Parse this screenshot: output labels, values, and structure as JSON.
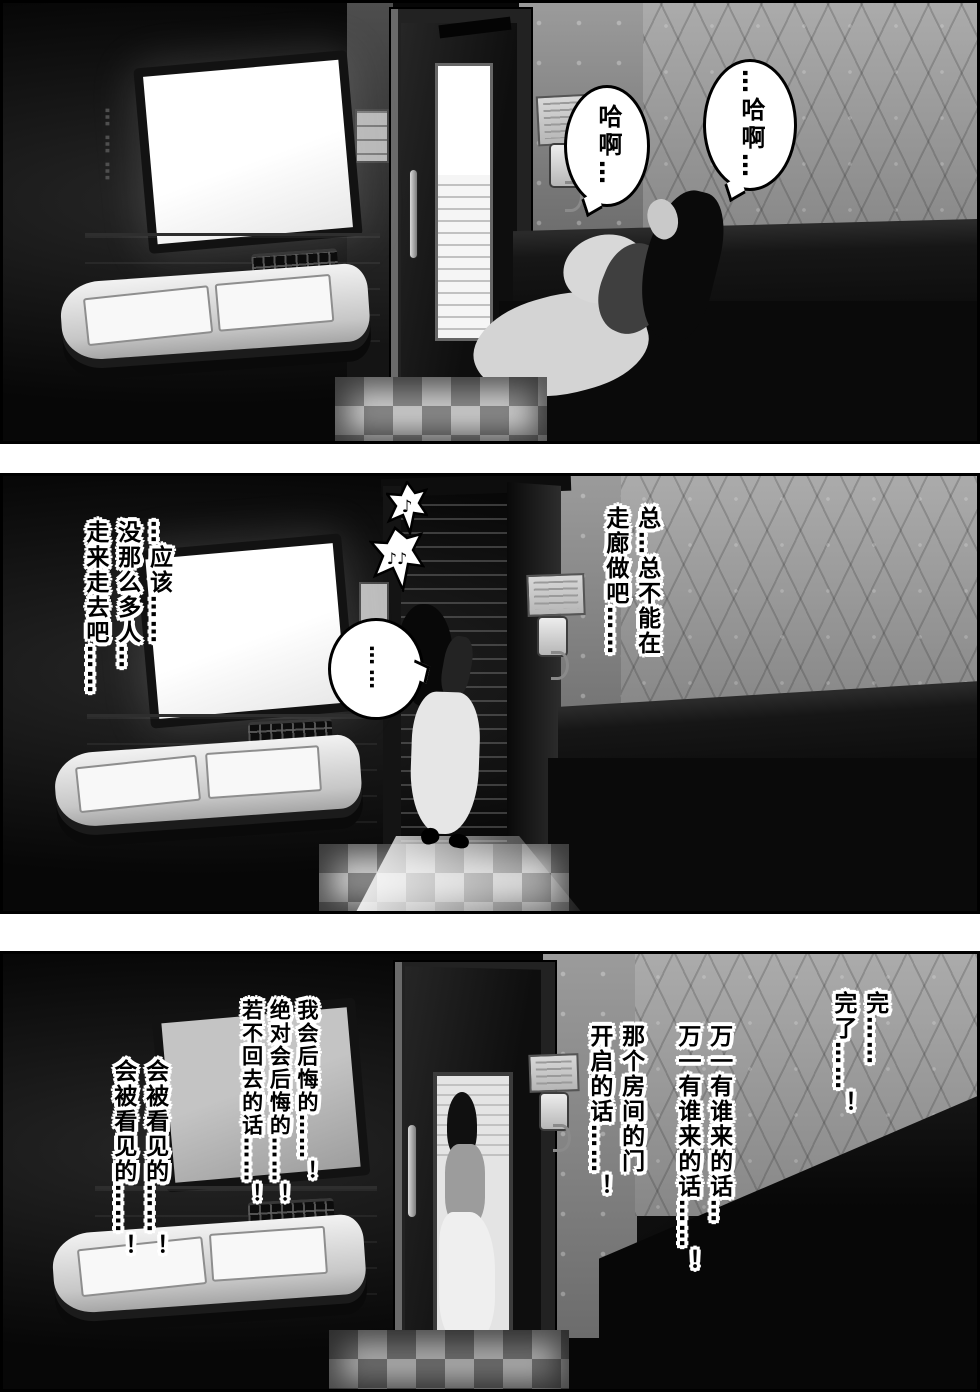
{
  "page": {
    "type": "manga-comic-page",
    "panel_count": 3
  },
  "colors": {
    "page_bg": "#ffffff",
    "panel_border": "#000000",
    "room_shadow": "#070707",
    "wallpaper_gray": "#9c9c9c",
    "bubble_fill": "#ffffff",
    "bubble_stroke": "#000000",
    "text_fill": "#000000",
    "text_outline": "#ffffff",
    "tv_screen": "#fafafa",
    "corridor_light": "#f5f5f5"
  },
  "panel1": {
    "sfx_dots": "………",
    "bubble_left": "哈啊…",
    "bubble_right": "…哈啊…"
  },
  "panel2": {
    "music_note_small": "♪",
    "music_note_large": "♪♪",
    "bubble_ellipsis": "……",
    "monologue_right": [
      "总…总不能在",
      "走廊做吧……"
    ],
    "monologue_left": [
      "…应该……",
      "没那么多人…",
      "走来走去吧……"
    ]
  },
  "panel3": {
    "monologue_far_right": [
      "完……",
      "完了……！"
    ],
    "monologue_right": [
      "万一有谁来的话…",
      "万一有谁来的话……！"
    ],
    "monologue_mid_right": [
      "那个房间的门",
      "开启的话……！"
    ],
    "monologue_mid_left": [
      "我会后悔的……！",
      "绝对会后悔的……！",
      "若不回去的话……！"
    ],
    "monologue_far_left": [
      "会被看见的……！",
      "会被看见的……！"
    ]
  }
}
